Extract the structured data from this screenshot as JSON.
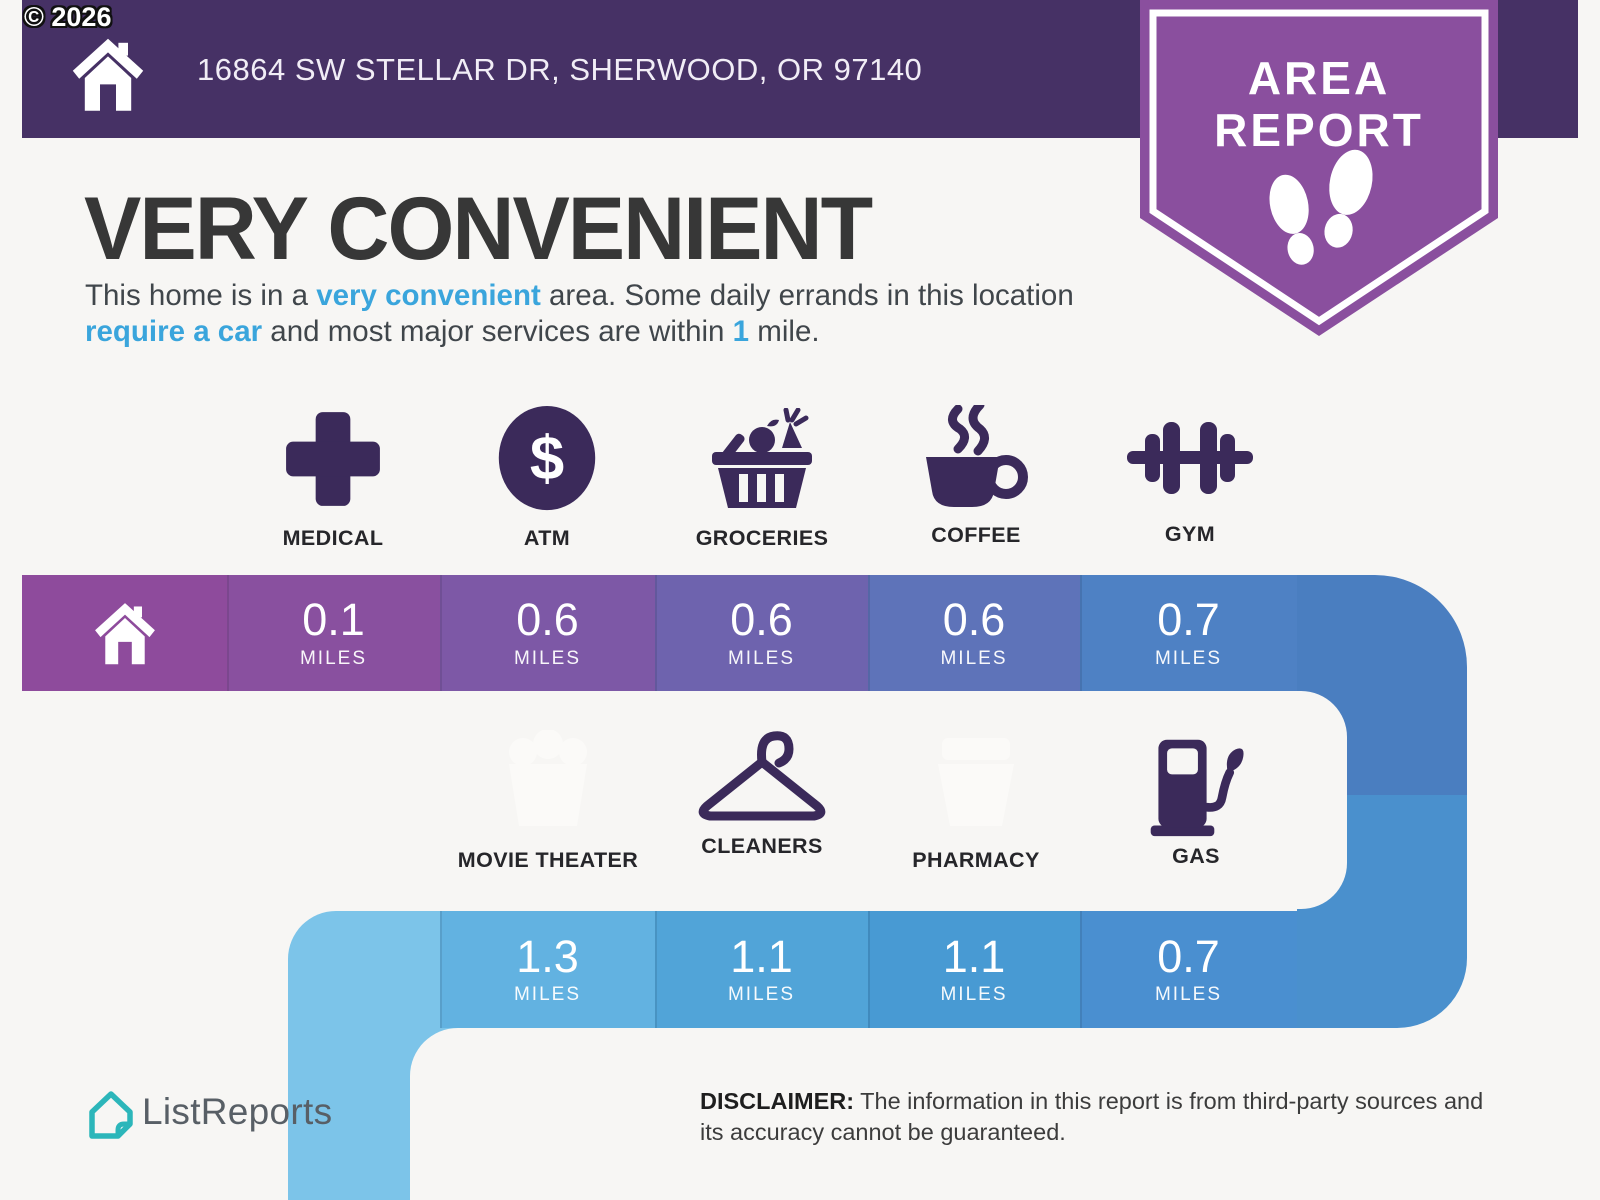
{
  "page": {
    "copyright": "© 2026",
    "background": "#f7f6f4"
  },
  "header": {
    "address": "16864 SW STELLAR DR, SHERWOOD, OR 97140",
    "bg_color": "#463165"
  },
  "badge": {
    "line1": "AREA",
    "line2": "REPORT",
    "bg_color": "#8a4f9e",
    "icon": "footprints-icon"
  },
  "summary": {
    "title": "VERY CONVENIENT",
    "p1": "This home is in a ",
    "h1": "very convenient",
    "p2": " area. Some daily errands in this location ",
    "h2": "require a car",
    "p3": " and most major services are within ",
    "h3": "1",
    "p4": " mile.",
    "highlight_color": "#3aa5dc"
  },
  "row1": {
    "home_icon": "home-icon",
    "home_color": "#8e4b9c",
    "items": [
      {
        "label": "MEDICAL",
        "icon": "medical-cross-icon",
        "distance": "0.1",
        "unit": "MILES",
        "color": "#89509f"
      },
      {
        "label": "ATM",
        "icon": "dollar-atm-icon",
        "distance": "0.6",
        "unit": "MILES",
        "color": "#7d58a6"
      },
      {
        "label": "GROCERIES",
        "icon": "grocery-basket-icon",
        "distance": "0.6",
        "unit": "MILES",
        "color": "#6e63ae"
      },
      {
        "label": "COFFEE",
        "icon": "coffee-cup-icon",
        "distance": "0.6",
        "unit": "MILES",
        "color": "#5e73b9"
      },
      {
        "label": "GYM",
        "icon": "dumbbell-icon",
        "distance": "0.7",
        "unit": "MILES",
        "color": "#4e81c4"
      }
    ]
  },
  "row2": {
    "items": [
      {
        "label": "MOVIE THEATER",
        "icon": "movie-theater-icon",
        "distance": "1.3",
        "unit": "MILES",
        "color": "#62b2e1"
      },
      {
        "label": "CLEANERS",
        "icon": "hanger-icon",
        "distance": "1.1",
        "unit": "MILES",
        "color": "#51a4d8"
      },
      {
        "label": "PHARMACY",
        "icon": "pharmacy-icon",
        "distance": "1.1",
        "unit": "MILES",
        "color": "#489ad3"
      },
      {
        "label": "GAS",
        "icon": "gas-pump-icon",
        "distance": "0.7",
        "unit": "MILES",
        "color": "#4a8fd0"
      }
    ]
  },
  "footer": {
    "logo_text": "ListReports",
    "logo_icon": "listreports-house-icon",
    "disclaimer_label": "DISCLAIMER:",
    "disclaimer_text": " The information in this report is from third-party sources and its accuracy cannot be guaranteed."
  }
}
